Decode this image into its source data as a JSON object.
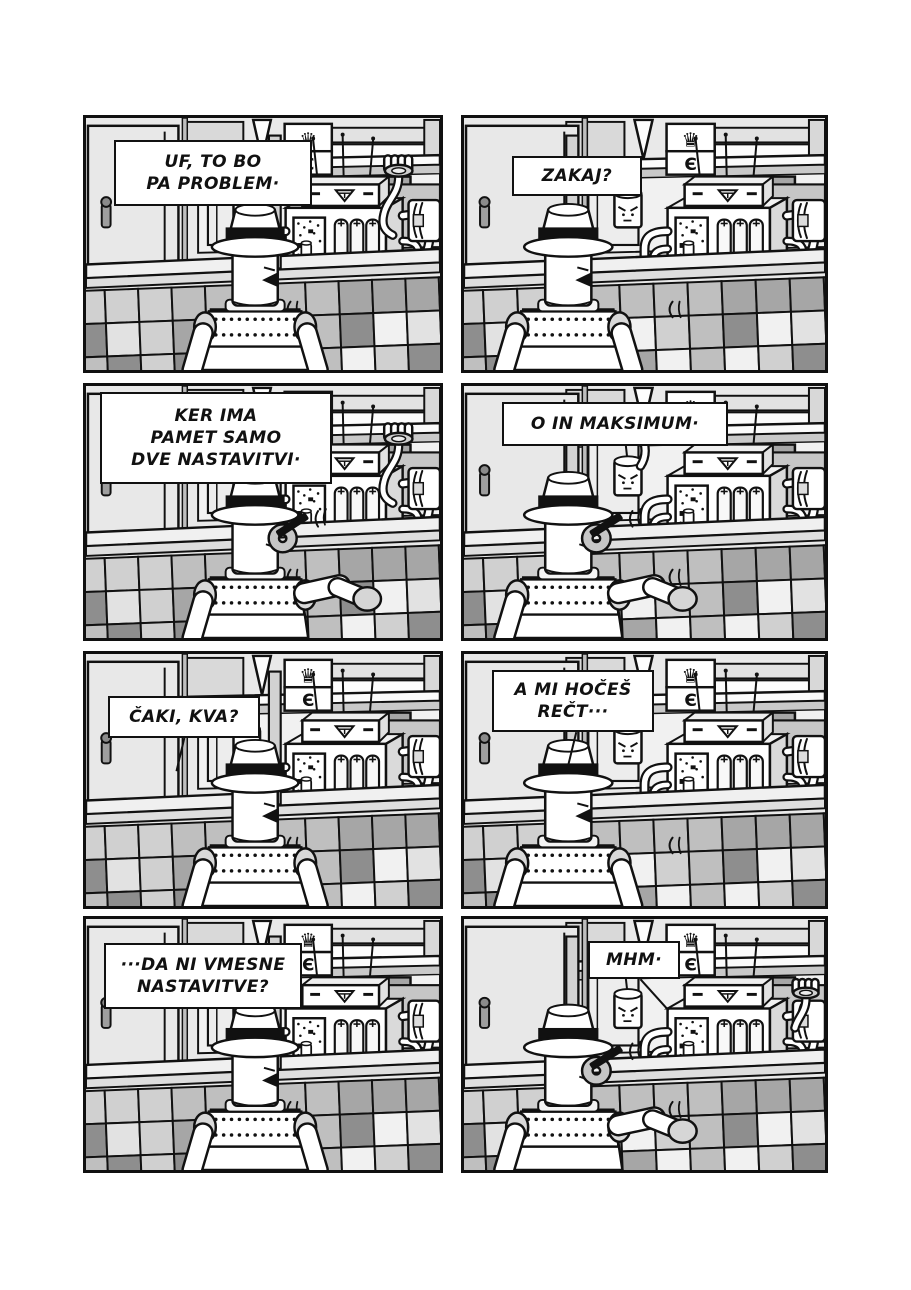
{
  "page": {
    "type": "comic-page",
    "panel_count": 8
  },
  "colors": {
    "ink": "#111111",
    "paper": "#ffffff",
    "wall": "#e9e9e9",
    "door": "#e8e8e8",
    "shelf_shadow": "#c9c9c9",
    "counter_top": "#f0f0f0",
    "counter_front": "#dedede",
    "dark_box": "#a6a6a6"
  },
  "icons": {
    "crown": "♛",
    "letter_e": "Є"
  },
  "panels": [
    {
      "speech": "UF, TO BO\nPA PROBLEM·"
    },
    {
      "speech": "ZAKAJ?"
    },
    {
      "speech": "KER IMA\nPAMET SAMO\nDVE NASTAVITVI·"
    },
    {
      "speech": "O IN MAKSIMUM·"
    },
    {
      "speech": "ČAKI, KVA?"
    },
    {
      "speech": "A MI HOČEŠ\nREČT···"
    },
    {
      "speech": "···DA NI VMESNE\nNASTAVITVE?"
    },
    {
      "speech": "MHM·"
    }
  ]
}
